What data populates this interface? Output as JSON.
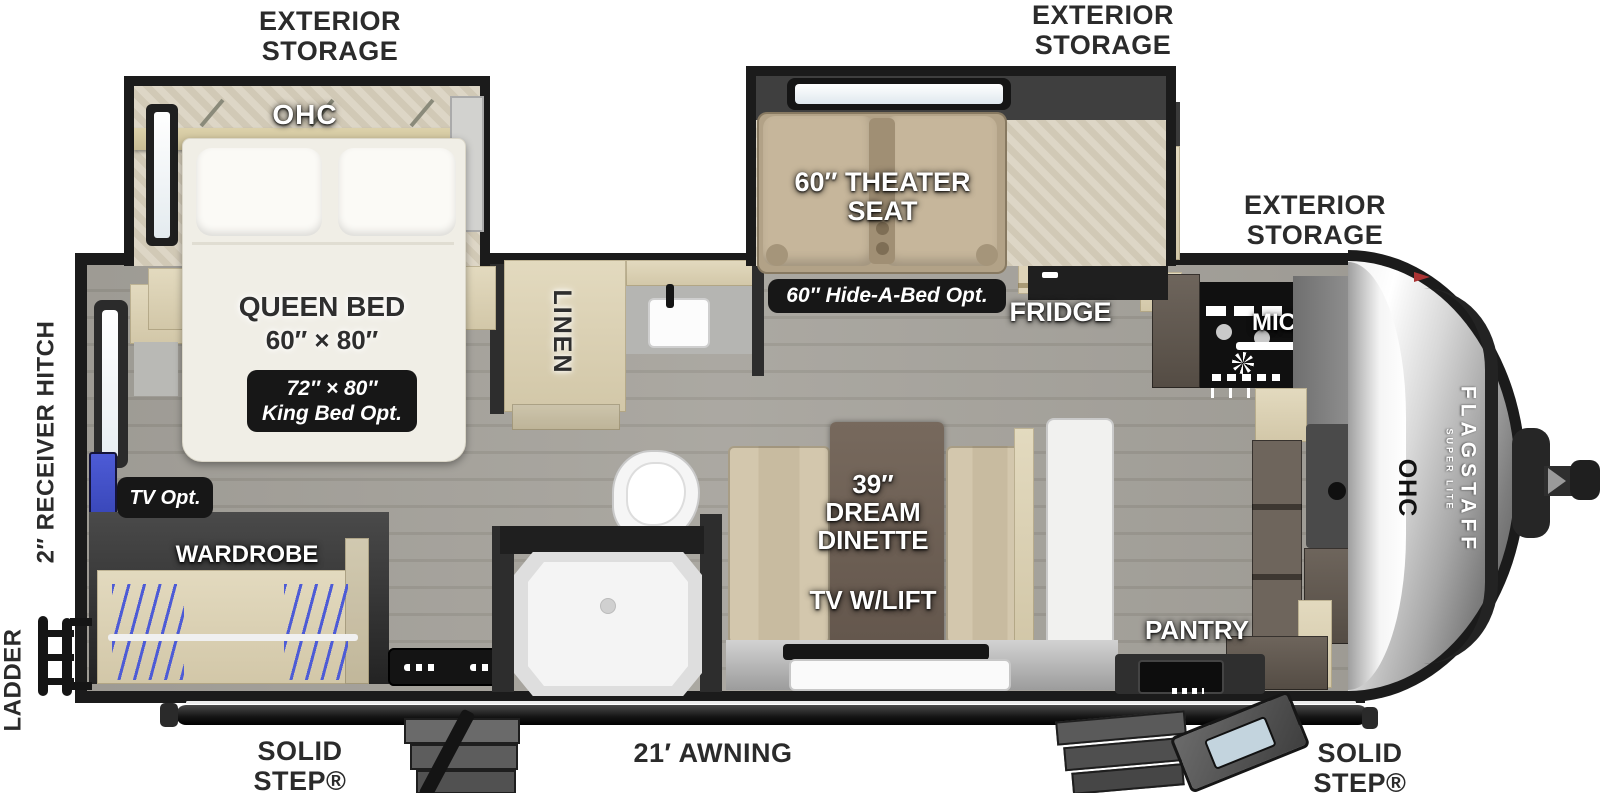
{
  "labels": {
    "exterior_storage_rear": "EXTERIOR STORAGE",
    "exterior_storage_mid": "EXTERIOR STORAGE",
    "exterior_storage_front": "EXTERIOR STORAGE",
    "receiver_hitch": "2″ RECEIVER HITCH",
    "ladder": "LADDER",
    "solid_step_rear": "SOLID STEP® ENTRY",
    "awning": "21′ AWNING",
    "solid_step_front": "SOLID STEP® ENTRY"
  },
  "bedroom": {
    "ohc": "OHC",
    "bed_title": "QUEEN BED",
    "bed_size": "60″ × 80″",
    "king_opt_line1": "72″ × 80″",
    "king_opt_line2": "King Bed Opt.",
    "tv_option": "TV Opt.",
    "wardrobe": "WARDROBE"
  },
  "bathroom": {
    "linen": "LINEN"
  },
  "living": {
    "theater_seat": "60″ THEATER SEAT",
    "hide_a_bed_option": "60″ Hide-A-Bed Opt.",
    "dinette": "39″ DREAM DINETTE",
    "tv_lift": "TV W/LIFT"
  },
  "kitchen": {
    "fridge": "FRIDGE",
    "micro": "MICRO",
    "pantry": "PANTRY",
    "ohc": "OHC"
  },
  "brand": {
    "name": "FLAGSTAFF",
    "sub": "SUPER LITE"
  },
  "colors": {
    "badge": "#171717",
    "wall": "#1b1b1b",
    "accent_blue": "#4d5bd6",
    "floor_gray": "#a19e97",
    "wood_light": "#dcd2b6",
    "wood_dark": "#675e57",
    "seat_tan": "#c6b69b",
    "cap_silver": "#c8c8c8"
  }
}
